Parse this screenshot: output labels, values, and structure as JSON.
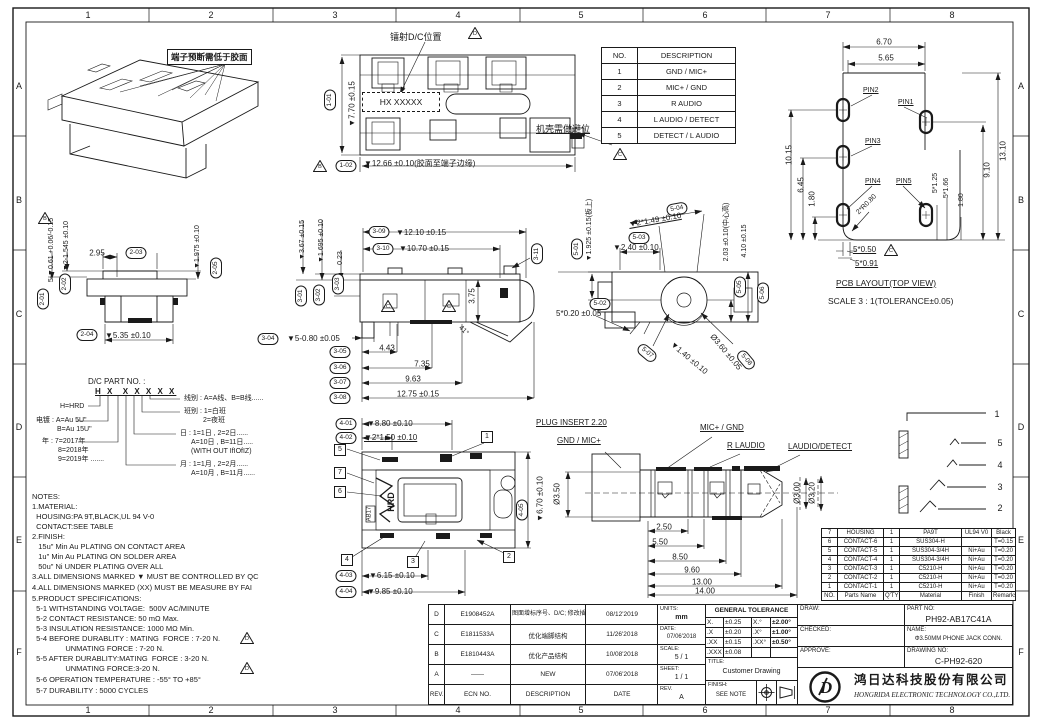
{
  "colors": {
    "line": "#1a1a1a",
    "paper": "#ffffff"
  },
  "frame": {
    "cols": [
      "1",
      "2",
      "3",
      "4",
      "5",
      "6",
      "7",
      "8"
    ],
    "rows": [
      "A",
      "B",
      "C",
      "D",
      "E",
      "F"
    ]
  },
  "annotations": {
    "terminal_note": "端子预断需低于胶面",
    "laser_note": "镭射D/C位置",
    "dc_code": "HX XXXXX",
    "case_note": "机壳需做避位",
    "tri_b": "B",
    "tri_c": "C",
    "tri_d": "D"
  },
  "desc_table": {
    "headers": [
      "NO.",
      "DESCRIPTION"
    ],
    "rows": [
      [
        "1",
        "GND / MIC+"
      ],
      [
        "2",
        "MIC+ / GND"
      ],
      [
        "3",
        "R AUDIO"
      ],
      [
        "4",
        "L AUDIO / DETECT"
      ],
      [
        "5",
        "DETECT / L AUDIO"
      ]
    ]
  },
  "view1": {
    "b1": "1-01",
    "d1": "▼7.70 ±0.15",
    "b2": "1-02",
    "d2": "▼12.66 ±0.10(胶面至端子边缘)"
  },
  "view2": {
    "b1": "2-01",
    "d1": "5-▼0.61 +0.06/-0.15",
    "b2": "2-02",
    "d2": "▼2-1.545 ±0.10",
    "b3": "2-03",
    "d3": "2.95",
    "b4": "2-04",
    "d4": "▼5.35 ±0.10",
    "b5": "2-05",
    "d5": "▼1.975 ±0.10"
  },
  "view3": {
    "b1": "3-01",
    "d1": "▼3.67 ±0.15",
    "b2": "3-02",
    "d2": "▼1.695 ±0.10",
    "b3": "3-03",
    "d3": "0.23",
    "b4": "3-04",
    "d4": "▼5-0.80 ±0.05",
    "b5": "3-05",
    "d5": "4.43",
    "b6": "3-06",
    "d6": "7.35",
    "b7": "3-07",
    "d7": "9.63",
    "b8": "3-08",
    "d8": "12.75 ±0.15",
    "b9": "3-09",
    "d9": "▼12.10 ±0.15",
    "b10": "3-10",
    "d10": "▼10.70 ±0.15",
    "b11": "3-11",
    "d11": "3.75",
    "angle": "41°"
  },
  "view4": {
    "b1": "4-01",
    "d1": "▼8.80 ±0.10",
    "b2": "4-02",
    "d2": "▼2*1.50 ±0.10",
    "b3": "4-03",
    "d3": "▼6.15 ±0.10",
    "b4": "4-04",
    "d4": "▼9.85 ±0.10",
    "b5": "4-05",
    "d5": "▼6.70 ±0.10",
    "hrd": "HRD",
    "ab17": "AB17",
    "c1": "1",
    "c2": "2",
    "c3": "3",
    "c4": "4",
    "c5": "5",
    "c6": "6",
    "c7": "7"
  },
  "view5": {
    "b1": "5-01",
    "d1": "▼1.925 ±0.15(板上)",
    "b2": "5-02",
    "d2": "5*0.20 ±0.05",
    "b3": "5-03",
    "d3": "▼2.40 ±0.10",
    "b4": "5-04",
    "d4": "▼2*1.49 ±0.10",
    "b5": "5-05",
    "d5": "2.03 ±0.10(中心高)",
    "b6": "5-06",
    "d6": "4.10 ±0.15",
    "b7": "5-07",
    "d7": "▼1.40 ±0.10",
    "b8": "5-08",
    "d8": "Ø3.60 ±0.05"
  },
  "pcb": {
    "title": "PCB LAYOUT(TOP VIEW)",
    "scale": "SCALE 3 : 1(TOLERANCE±0.05)",
    "pin1": "PIN1",
    "pin2": "PIN2",
    "pin3": "PIN3",
    "pin4": "PIN4",
    "pin5": "PIN5",
    "d670": "6.70",
    "d565": "5.65",
    "d1015": "10.15",
    "d645": "6.45",
    "d180l": "1.80",
    "d1310": "13.10",
    "d910": "9.10",
    "d5125": "5*1.25",
    "d5166": "5*1.66",
    "d180r": "1.80",
    "r080": "2*R0.80",
    "d5050": "5*0.50",
    "d5091": "5*0.91"
  },
  "plug": {
    "title": "PLUG INSERT 2.20",
    "gnd": "GND / MIC+",
    "mic": "MIC+ / GND",
    "raudio": "R LAUDIO",
    "laudio": "LAUDIO/DETECT",
    "dia1": "Ø3.50",
    "dia2": "Ø3.00",
    "dia3": "Ø3.20",
    "d1": "2.50",
    "d2": "5.50",
    "d3": "8.50",
    "d4": "9.60",
    "d5": "13.00",
    "d6": "14.00"
  },
  "pins_schematic": {
    "n1": "1",
    "n2": "5",
    "n3": "4",
    "n4": "3",
    "n5": "2"
  },
  "dc_legend": {
    "title": "D/C PART NO. :",
    "code": "H X  X X X X X",
    "h": "H=HRD",
    "plating1": "电镀 : A=Au 5U\"",
    "plating2": "B=Au 15U\"",
    "year1": "年 : 7=2017年",
    "year2": "8=2018年",
    "year3": "9=2019年 .......",
    "wire": "线别 : A=A线、B=B线......",
    "shift1": "班别 : 1=白班",
    "shift2": "2=夜班",
    "day1": "日 : 1=1日 , 2=2日......",
    "day2": "A=10日 , B=11日.....",
    "day3": "(WITH OUT IfIOfIZ)",
    "month1": "月 : 1=1月 , 2=2月......",
    "month2": "A=10月 , B=11月......"
  },
  "notes": {
    "lines": [
      "NOTES:",
      "1.MATERIAL:",
      "  HOUSING:PA 9T,BLACK,UL 94 V-0",
      "  CONTACT:SEE TABLE",
      "2.FINISH:",
      "   15u\" Min Au PLATING ON CONTACT AREA",
      "   1u\" Min Au PLATING ON SOLDER AREA",
      "   50u\" Ni UNDER PLATING OVER ALL",
      "3.ALL DIMENSIONS MARKED ▼ MUST BE CONTROLLED BY QC",
      "4.ALL DIMENSIONS MARKED (XX) MUST BE MEASURE BY FAI",
      "5.PRODUCT SPECIFICATIONS:",
      "  5-1 WITHSTANDING VOLTAGE:  500V AC/MINUTE",
      "  5-2 CONTACT RESISTANCE: 50 mΩ Max.",
      "  5-3 INSULATION RESISTANCE: 1000 MΩ Min.",
      "  5-4 BEFORE DURABLITY : MATING  FORCE : 7-20 N.",
      "                UNMATING FORCE : 7-20 N.",
      "  5-5 AFTER DURABLITY:MATING  FORCE : 3-20 N.",
      "                UNMATING FORCE:3-20 N.",
      "  5-6 OPERATION TEMPERATURE : -55° TO +85°",
      "  5-7 DURABILITY : 5000 CYCLES"
    ]
  },
  "parts_table": {
    "headers": [
      "NO.",
      "Parts Name",
      "Q'TY",
      "Material",
      "Finish",
      "Remarks"
    ],
    "rows": [
      [
        "7",
        "HOUSING",
        "1",
        "PA9T",
        "UL94 V0",
        "Black"
      ],
      [
        "6",
        "CONTACT-6",
        "1",
        "SUS304-H",
        "",
        "T=0.15"
      ],
      [
        "5",
        "CONTACT-5",
        "1",
        "SUS304-3/4H",
        "Ni+Au",
        "T=0.20"
      ],
      [
        "4",
        "CONTACT-4",
        "1",
        "SUS304-3/4H",
        "Ni+Au",
        "T=0.20"
      ],
      [
        "3",
        "CONTACT-3",
        "1",
        "C5210-H",
        "Ni+Au",
        "T=0.20"
      ],
      [
        "2",
        "CONTACT-2",
        "1",
        "C5210-H",
        "Ni+Au",
        "T=0.20"
      ],
      [
        "1",
        "CONTACT-1",
        "1",
        "C5210-H",
        "Ni+Au",
        "T=0.20"
      ]
    ]
  },
  "rev_table": {
    "headers": [
      "REV.",
      "ECN NO.",
      "DESCRIPTION",
      "DATE"
    ],
    "rows": [
      [
        "D",
        "E1908452A",
        "图面增标序号、D/C; 修改插拔力规格",
        "08/12'2019"
      ],
      [
        "C",
        "E1811533A",
        "优化端脚结构",
        "11/26'2018"
      ],
      [
        "B",
        "E1810443A",
        "优化产品结构",
        "10/08'2018"
      ],
      [
        "A",
        "——",
        "NEW",
        "07/06'2018"
      ]
    ]
  },
  "info": {
    "units_label": "UNITS:",
    "units": "mm",
    "date_label": "DATE:",
    "date": "07/06'2018",
    "scale_label": "SCALE:",
    "scale": "5 / 1",
    "sheet_label": "SHEET:",
    "sheet": "1 / 1",
    "rev_label": "REV.",
    "rev": "A"
  },
  "tolerance": {
    "title": "GENERAL TOLERANCE",
    "c00": "X.",
    "c01": "±0.25",
    "c02": "X.°",
    "c03": "±2.00°",
    "c10": ".X",
    "c11": "±0.20",
    "c12": ".X°",
    "c13": "±1.00°",
    "c20": ".XX",
    "c21": "±0.15",
    "c22": ".XX°",
    "c23": "±0.50°",
    "c30": ".XXX",
    "c31": "±0.08",
    "c32": "",
    "c33": ""
  },
  "title_block": {
    "draw": "DRAW:",
    "checked": "CHECKED:",
    "approve": "APPROVE:",
    "title_label": "TITLE:",
    "title": "Customer Drawing",
    "finish_label": "FINISH:",
    "finish": "SEE NOTE",
    "part_no_label": "PART NO:",
    "part_no": "PH92-AB17C41A",
    "name_label": "NAME:",
    "name": "Φ3.50MM PHONE JACK CONN.",
    "drawing_no_label": "DRAWING NO:",
    "drawing_no": "C-PH92-620",
    "company_cn": "鸿日达科技股份有限公司",
    "company_en": "HONGRIDA ELECTRONIC TECHNOLOGY CO.,LTD."
  }
}
